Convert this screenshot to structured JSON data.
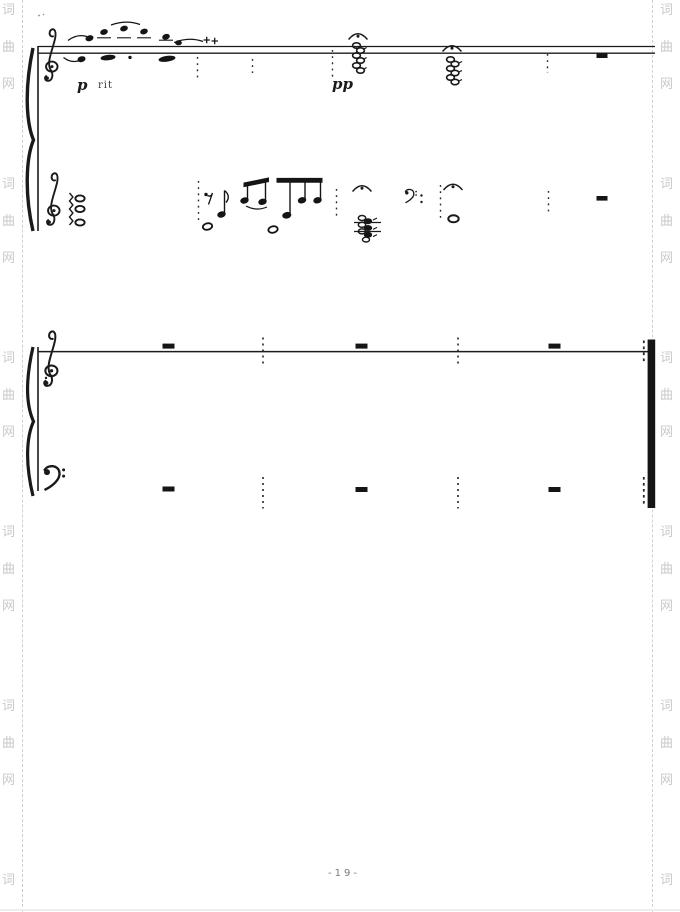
{
  "watermark": {
    "site_name": "词曲网",
    "chars": [
      "词",
      "曲",
      "网"
    ],
    "color": "#c9c9c9"
  },
  "score": {
    "dynamics": {
      "p": "p",
      "rit": "rit",
      "pp": "pp"
    },
    "page_number_label": "-19-"
  }
}
